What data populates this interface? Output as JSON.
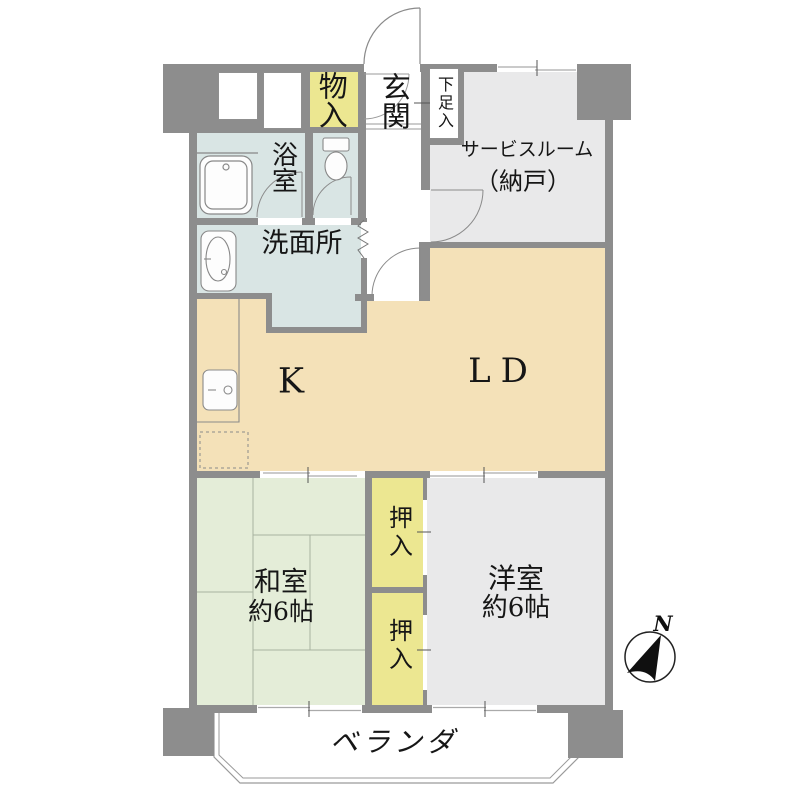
{
  "plan_title": "マンション間取り図",
  "colors": {
    "wall": "#8d8d8d",
    "outline": "#8a8a8a",
    "floor_kitchen_living": "#f4e1b8",
    "floor_wet_area": "#d9e5e4",
    "floor_tatami": "#e4edd8",
    "floor_western": "#e9e9ea",
    "floor_closet": "#ece791",
    "floor_hall": "#ffffff"
  },
  "rooms": {
    "storage_top": {
      "label": "物入"
    },
    "entrance": {
      "label": "玄関"
    },
    "shoe_cabinet": {
      "label": "下足入"
    },
    "bathroom": {
      "label": "浴室"
    },
    "washroom": {
      "label": "洗面所"
    },
    "service_room": {
      "name": "サービスルーム",
      "sub": "（納戸）"
    },
    "kitchen": {
      "label": "K"
    },
    "living_dining": {
      "label": "LD"
    },
    "japanese_room": {
      "label": "和室",
      "size": "約6帖"
    },
    "western_room": {
      "label": "洋室",
      "size": "約6帖"
    },
    "closet_upper": {
      "label": "押入"
    },
    "closet_lower": {
      "label": "押入"
    },
    "veranda": {
      "label": "ベランダ"
    }
  },
  "compass": {
    "north_label": "N"
  }
}
